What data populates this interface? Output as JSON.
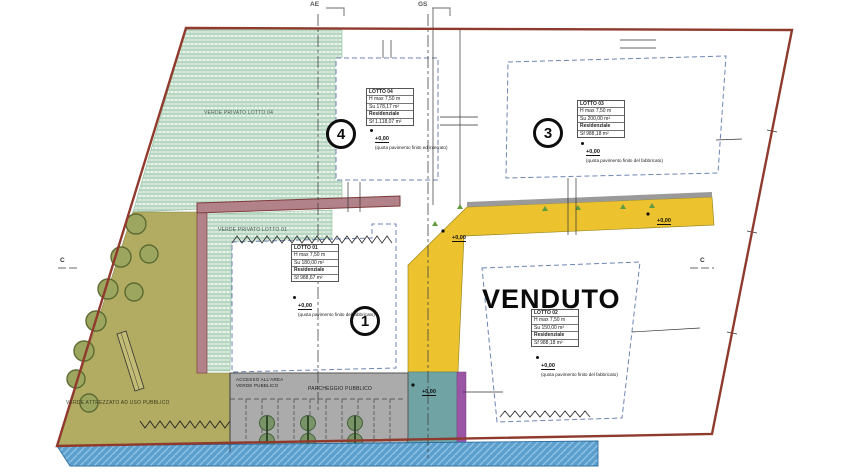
{
  "plan": {
    "sold_label": "VENDUTO",
    "section_labels": {
      "top_left": "AE",
      "top_right": "GS",
      "side_left": "C",
      "side_right": "C"
    },
    "area_labels": {
      "verde_privato_lotto04": "VERDE PRIVATO LOTTO 04",
      "verde_privato_lotto01": "VERDE PRIVATO LOTTO 01",
      "verde_attrezzato": "VERDE ATTREZZATO AD USO PUBBLICO",
      "accesso_line1": "ACCESSO ALL'AREA",
      "accesso_line2": "VERDE PUBBLICO",
      "parcheggio": "PARCHEGGIO PUBBLICO"
    },
    "lots": {
      "lot1": {
        "number": "1",
        "table": [
          "LOTTO 01",
          "H max 7,50 m",
          "Su 180,00 m²",
          "Residenziale",
          "Sf 988,67 m²"
        ],
        "quota": "+0,00",
        "quota_note": "(quota pavimento finito del fabbricato)"
      },
      "lot2": {
        "table": [
          "LOTTO 02",
          "H max 7,50 m",
          "Su 150,00 m²",
          "Residenziale",
          "Sf 988,18 m²"
        ],
        "quota": "+0,00",
        "quota_note": "(quota pavimento finito del fabbricato)",
        "status": "VENDUTO"
      },
      "lot3": {
        "number": "3",
        "table": [
          "LOTTO 03",
          "H max 7,50 m",
          "Su 200,00 m²",
          "Residenziale",
          "Sf 988,18 m²"
        ],
        "quota": "+0,00",
        "quota_note": "(quota pavimento finito del fabbricato)"
      },
      "lot4": {
        "number": "4",
        "table": [
          "LOTTO 04",
          "H max 7,50 m",
          "Su 178,17 m²",
          "Residenziale",
          "Sf 1.118,07 m²"
        ],
        "quota": "+0,00",
        "quota_note": "(quota pavimento finito ed interrato)"
      }
    },
    "road_markers": {
      "corner": "+0,00",
      "top": "+0,00",
      "ramp": "+0,00"
    },
    "colors": {
      "parcel_outline": "#8F3A2C",
      "road_yellow": "#ECC22F",
      "green_hatch": "#CFE6D6",
      "public_green_olive": "#B2AC62",
      "sidewalk_mauve": "#B18289",
      "parking_gray": "#ABABAB",
      "water_blue": "#5C9FCC",
      "ramp_teal": "#6FA3A4",
      "accent_purple": "#9C55A5",
      "lot_boundary_dashed": "#6C85B5",
      "tree_green": "#7A9467"
    }
  }
}
